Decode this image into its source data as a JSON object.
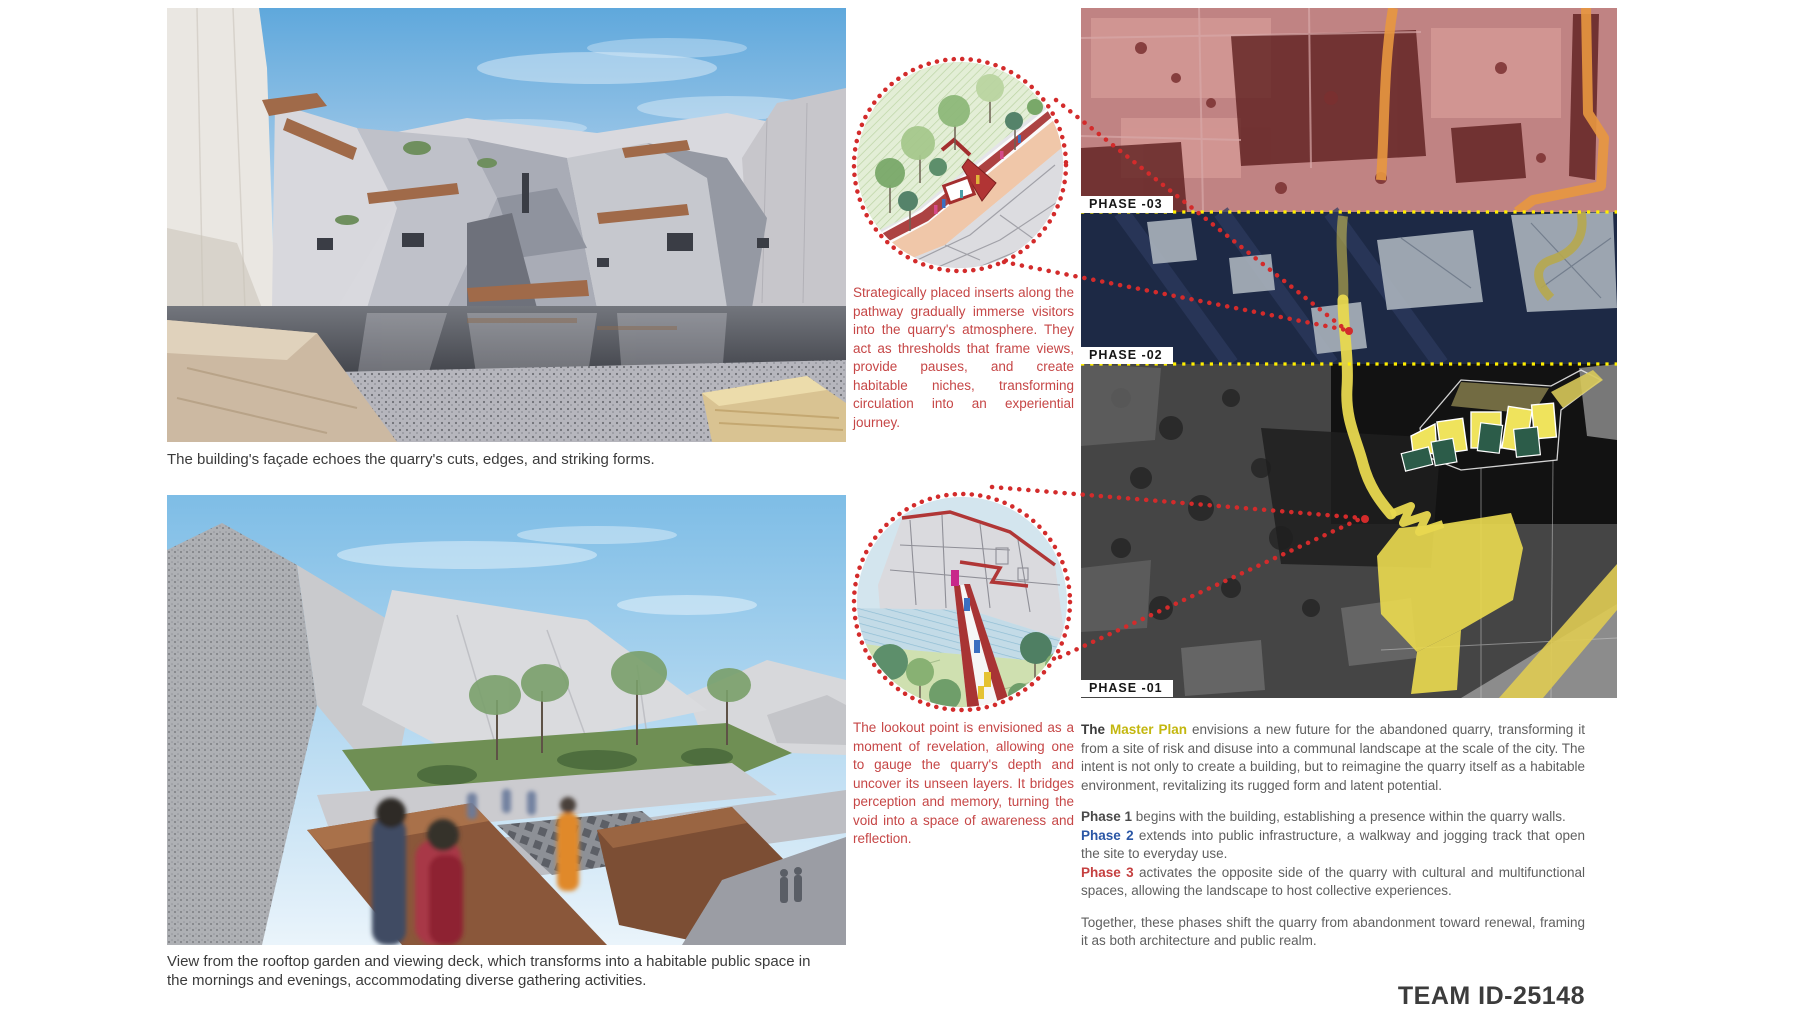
{
  "board": {
    "team_id": "TEAM ID-25148"
  },
  "left_column": {
    "render1_caption": "The building's façade echoes the quarry's cuts, edges, and striking forms.",
    "render2_caption": "View from the rooftop garden and viewing deck, which transforms into a habitable public space in the mornings and evenings, accommodating diverse gathering activities."
  },
  "callouts": {
    "inserts_text": "Strategically placed inserts along the pathway gradually immerse visitors into the quarry's atmosphere. They act as thresholds that frame views, provide pauses, and create habitable niches, transforming circulation into an experiential journey.",
    "lookout_text": "The lookout point is envisioned as a moment of revelation, allowing one to gauge the quarry's depth and uncover its unseen layers. It bridges perception and memory, turning the void into a space of awareness and reflection."
  },
  "map": {
    "phase_labels": [
      "PHASE -03",
      "PHASE -02",
      "PHASE -01"
    ]
  },
  "master_plan": {
    "intro_prefix": "The ",
    "intro_highlight": "Master Plan",
    "intro_rest": " envisions a new future for the abandoned quarry, transforming it from a site of risk and disuse into a communal landscape at the scale of the city. The intent is not only to create a building, but to reimagine the quarry itself as a habitable environment, revitalizing its rugged form and latent potential.",
    "phases": [
      {
        "label": "Phase 1",
        "text": " begins with the building, establishing a presence within the quarry walls."
      },
      {
        "label": "Phase 2",
        "text": " extends into public infrastructure, a walkway and jogging track that open the site to everyday use."
      },
      {
        "label": "Phase 3",
        "text": " activates the opposite side of the quarry with cultural and multifunctional spaces, allowing the landscape to host collective experiences."
      }
    ],
    "closing": "Together, these phases shift the quarry from abandonment toward renewal, framing it as both architecture and public realm."
  },
  "colors": {
    "callout_red": "#c64646",
    "highlight_yellow": "#c3b70f",
    "phase1_dark": "#4a4a4a",
    "phase2_blue": "#2a56a5",
    "phase3_red": "#c54040",
    "map_phase3_tint": "#c08383",
    "map_phase2_tint": "#1d2945",
    "map_masterplan_yellow": "#e8d84f",
    "phase_boundary_yellow": "#ffee00",
    "leader_dot_red": "#d32b2b"
  }
}
